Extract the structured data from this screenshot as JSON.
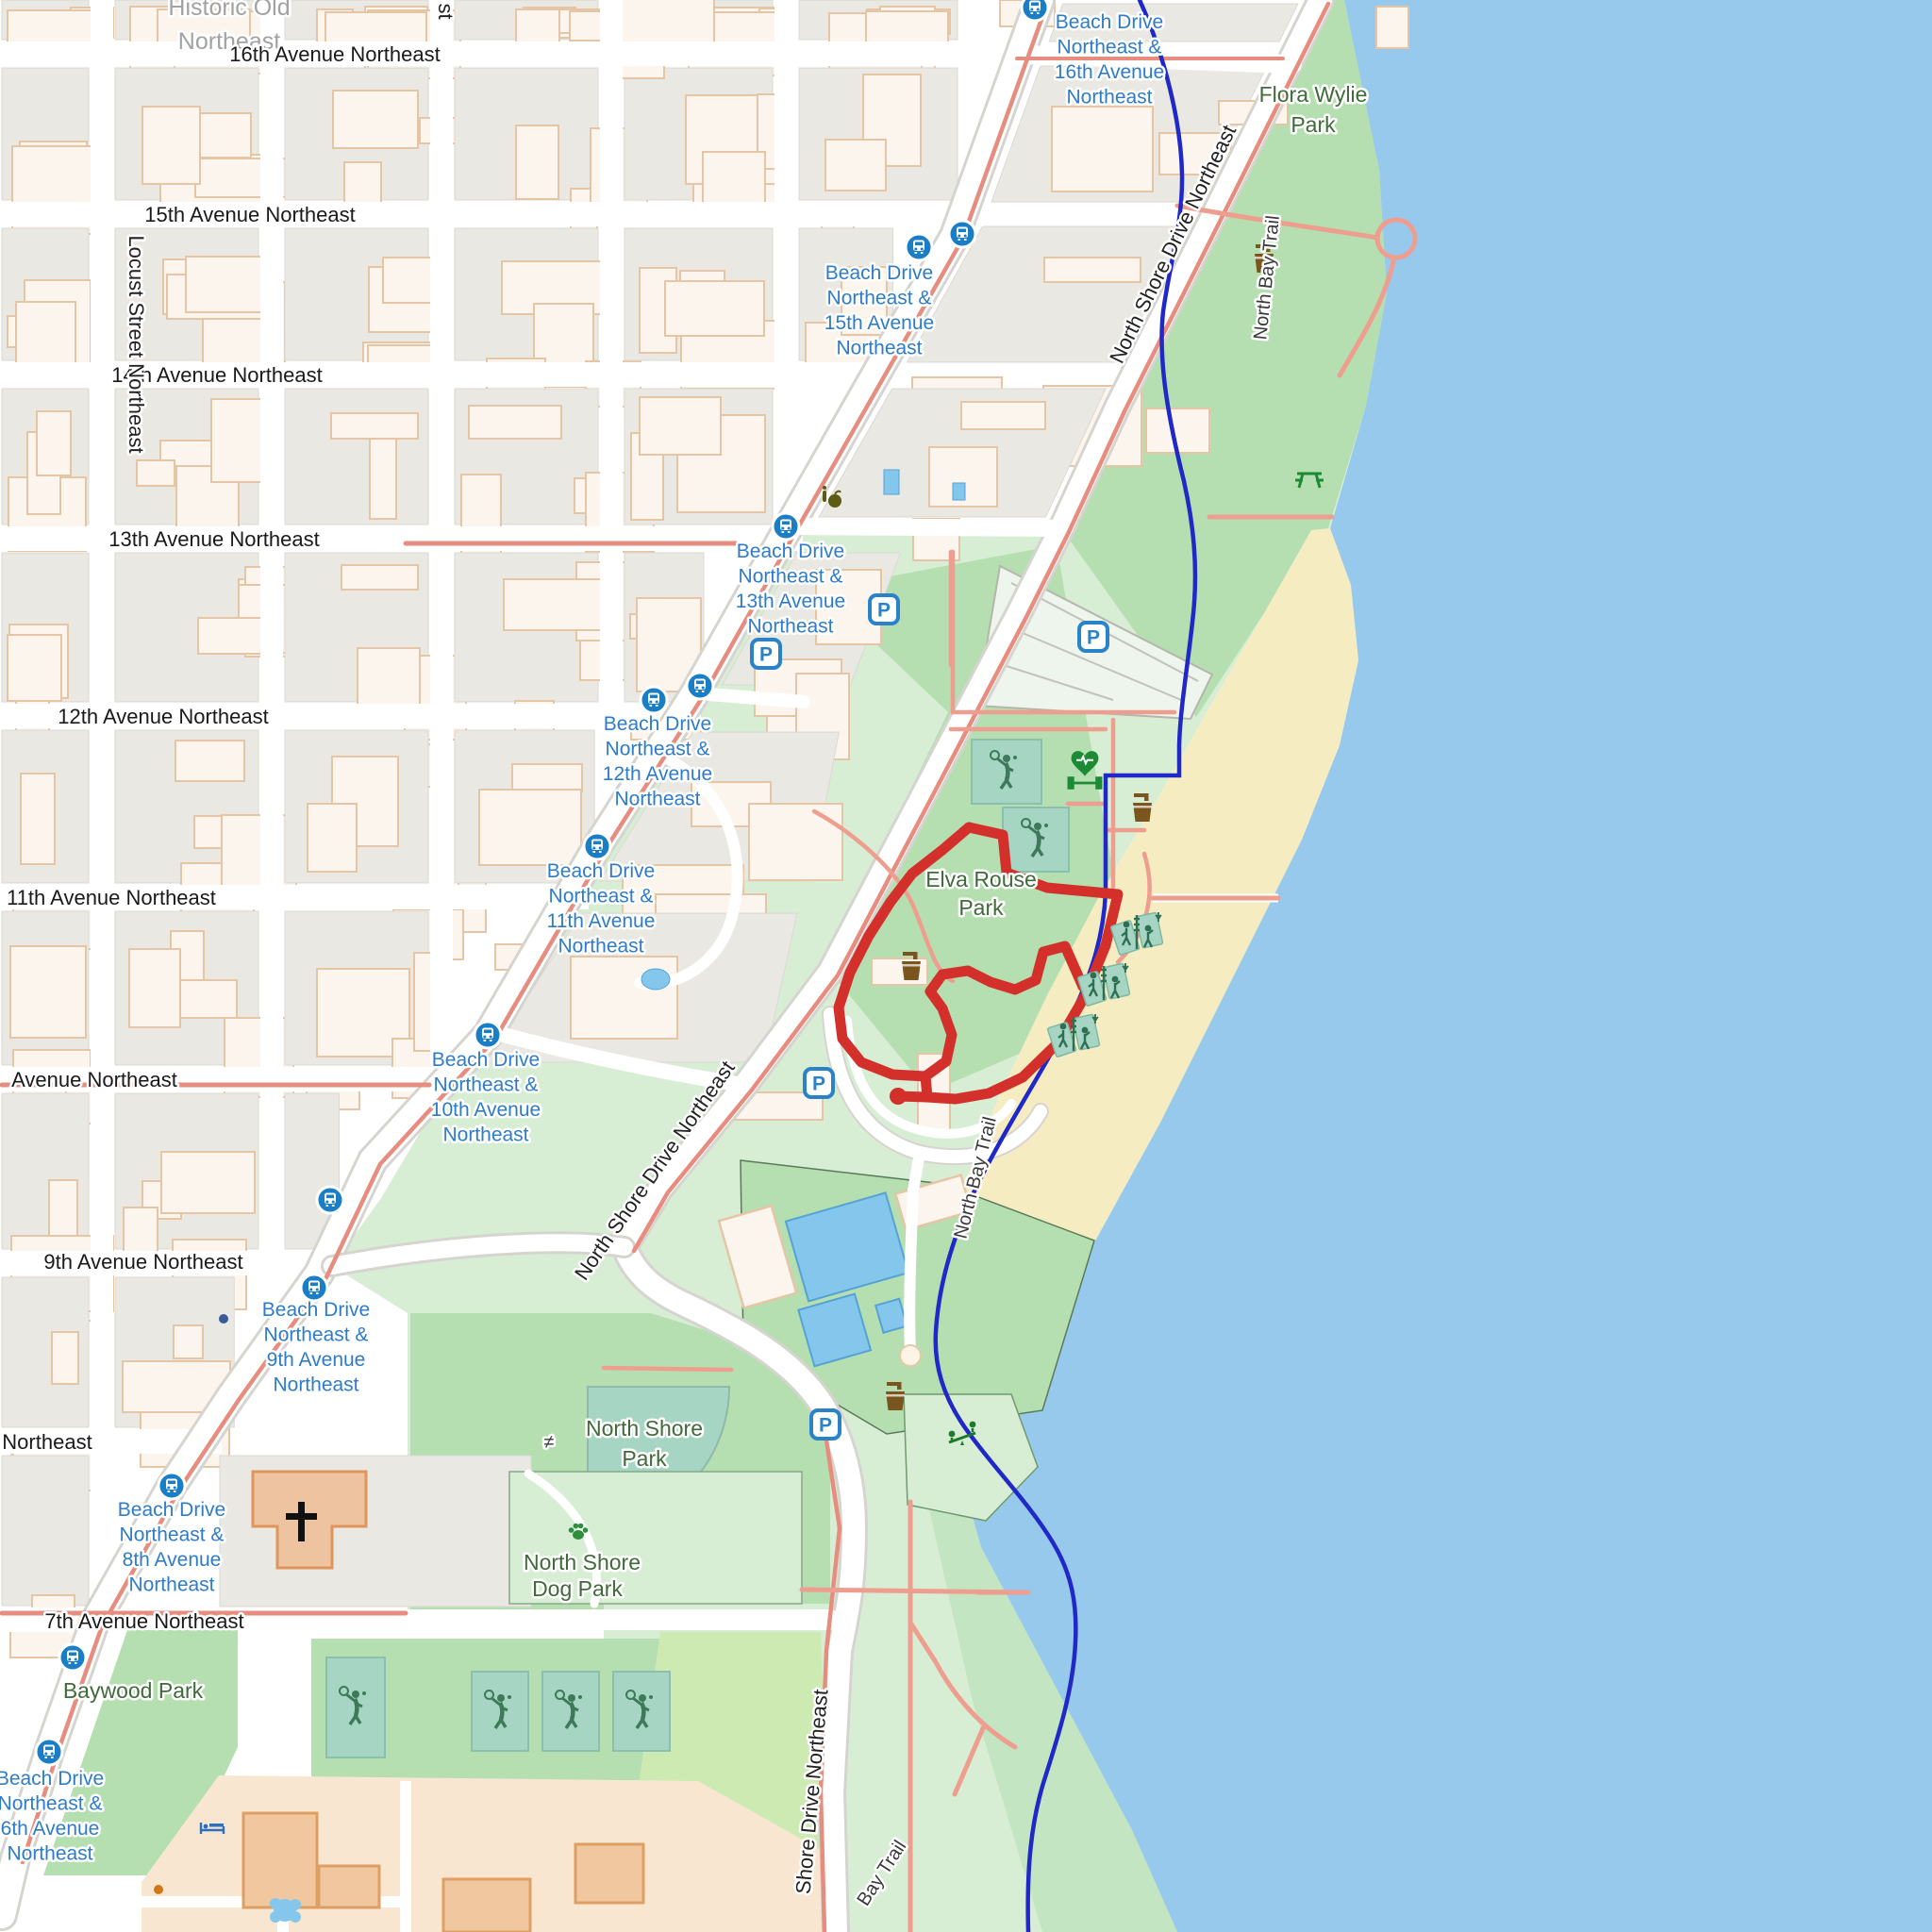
{
  "map": {
    "colors": {
      "water": "#97c9ec",
      "sand": "#f6ecc2",
      "green1": "#b5dfb0",
      "green2": "#d7eed4",
      "grass": "#cdeab2",
      "pitch": "#a6d5c4",
      "pitch_line": "#8cc0ae",
      "block": "#e9e8e3",
      "block_line": "#dbd9d3",
      "bldg": "#fcf5ed",
      "bldg_line": "#e6c5a5",
      "road_case": "#d6d4cf",
      "salmon": "#e78d80",
      "path_pink": "#ee9e8f",
      "trail": "#2029c8",
      "route": "#d3302b",
      "bus": "#1a7ec6",
      "p_blue": "#2a83c8",
      "label_blue": "#2e7cc9",
      "label_dark": "#1a1a1a",
      "label_green": "#406a3a",
      "label_dog": "#2f8f3f",
      "label_gray": "#a2a2a2",
      "icon_green": "#2c7d32",
      "icon_brown": "#7a551e",
      "peach": "#f9e6d1",
      "orange_bldg": "#f1c79f",
      "orange_line": "#dd9f63",
      "pool": "#85c7ec",
      "pool_line": "#55a3d6"
    },
    "street_labels": {
      "historic": [
        "Historic Old",
        "Northeast"
      ],
      "avenues": [
        "16th Avenue Northeast",
        "15th Avenue Northeast",
        "14th Avenue Northeast",
        "13th Avenue Northeast",
        "12th Avenue Northeast",
        "11th Avenue Northeast",
        "Avenue Northeast",
        "9th Avenue Northeast",
        "Northeast",
        "7th Avenue Northeast"
      ],
      "locust": "Locust Street Northeast",
      "fragment": "st",
      "north_shore_drive": "North Shore Drive Northeast",
      "shore_drive": "Shore Drive Northeast"
    },
    "trails": {
      "north_bay": "North Bay Trail",
      "bay": "Bay Trail"
    },
    "parks": {
      "flora": [
        "Flora Wylie",
        "Park"
      ],
      "elva": [
        "Elva Rouse",
        "Park"
      ],
      "north_shore": [
        "North Shore",
        "Park"
      ],
      "dog": [
        "North Shore",
        "Dog Park"
      ],
      "baywood": "Baywood Park"
    },
    "bus_stops": [
      {
        "lines": [
          "Beach Drive",
          "Northeast &",
          "16th Avenue",
          "Northeast"
        ]
      },
      {
        "lines": [
          "Beach Drive",
          "Northeast &",
          "15th Avenue",
          "Northeast"
        ]
      },
      {
        "lines": [
          "Beach Drive",
          "Northeast &",
          "13th Avenue",
          "Northeast"
        ]
      },
      {
        "lines": [
          "Beach Drive",
          "Northeast &",
          "12th Avenue",
          "Northeast"
        ]
      },
      {
        "lines": [
          "Beach Drive",
          "Northeast &",
          "11th Avenue",
          "Northeast"
        ]
      },
      {
        "lines": [
          "Beach Drive",
          "Northeast &",
          "10th Avenue",
          "Northeast"
        ]
      },
      {
        "lines": [
          "Beach Drive",
          "Northeast &",
          "9th Avenue",
          "Northeast"
        ]
      },
      {
        "lines": [
          "Beach Drive",
          "Northeast &",
          "8th Avenue",
          "Northeast"
        ]
      },
      {
        "lines": [
          "Beach Drive",
          "Northeast &",
          "6th Avenue",
          "Northeast"
        ]
      }
    ],
    "misc": {
      "gate": "≠",
      "parking": "P"
    }
  }
}
